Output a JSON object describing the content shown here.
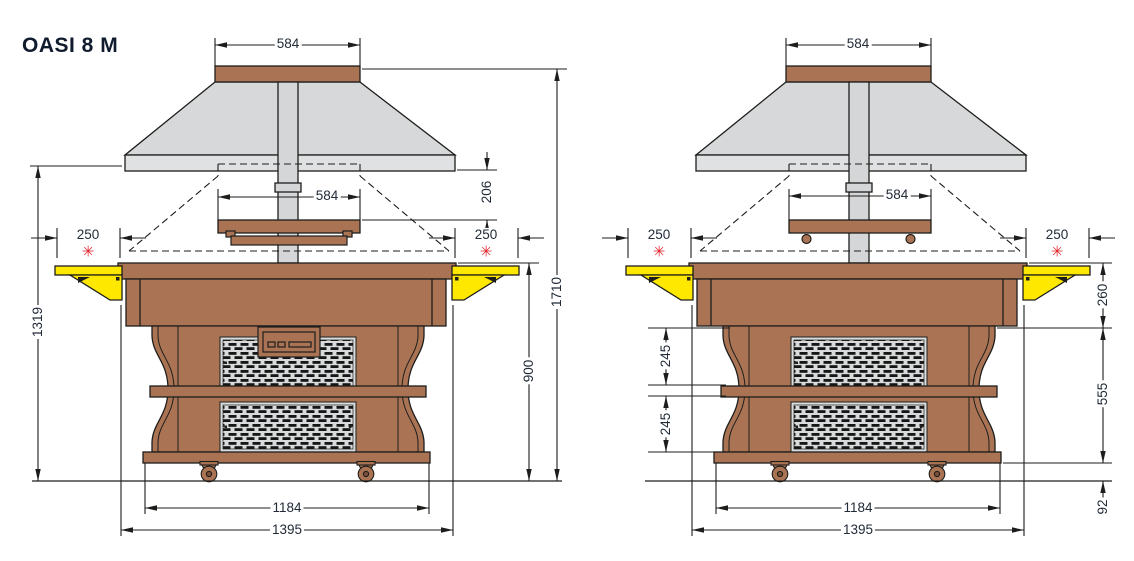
{
  "title": "OASI 8 M",
  "symbols": {
    "asterisk": "✳"
  },
  "colors": {
    "wood_brown": "#aa7454",
    "hood_gray": "#d7d8d9",
    "bracket_yellow": "#ffe800",
    "asterisk_red": "#e3232a",
    "line_black": "#1d1d1b",
    "dimension_text": "#222b38"
  },
  "front_view": {
    "dims": {
      "hood_cap_width": "584",
      "shelf_width": "584",
      "hood_to_shelf": "206",
      "tray_slide_left": "250",
      "tray_slide_right": "250",
      "hood_bottom_height": "1319",
      "worktop_height": "900",
      "overall_height": "1710",
      "base_width": "1184",
      "overall_width": "1395"
    }
  },
  "side_view": {
    "dims": {
      "hood_cap_width": "584",
      "shelf_width": "584",
      "tray_slide_left": "250",
      "tray_slide_right": "250",
      "upper_grille_height": "245",
      "lower_grille_height": "245",
      "counter_section_height": "260",
      "body_section_height": "555",
      "caster_clearance": "92",
      "base_width": "1184",
      "overall_width": "1395"
    }
  }
}
